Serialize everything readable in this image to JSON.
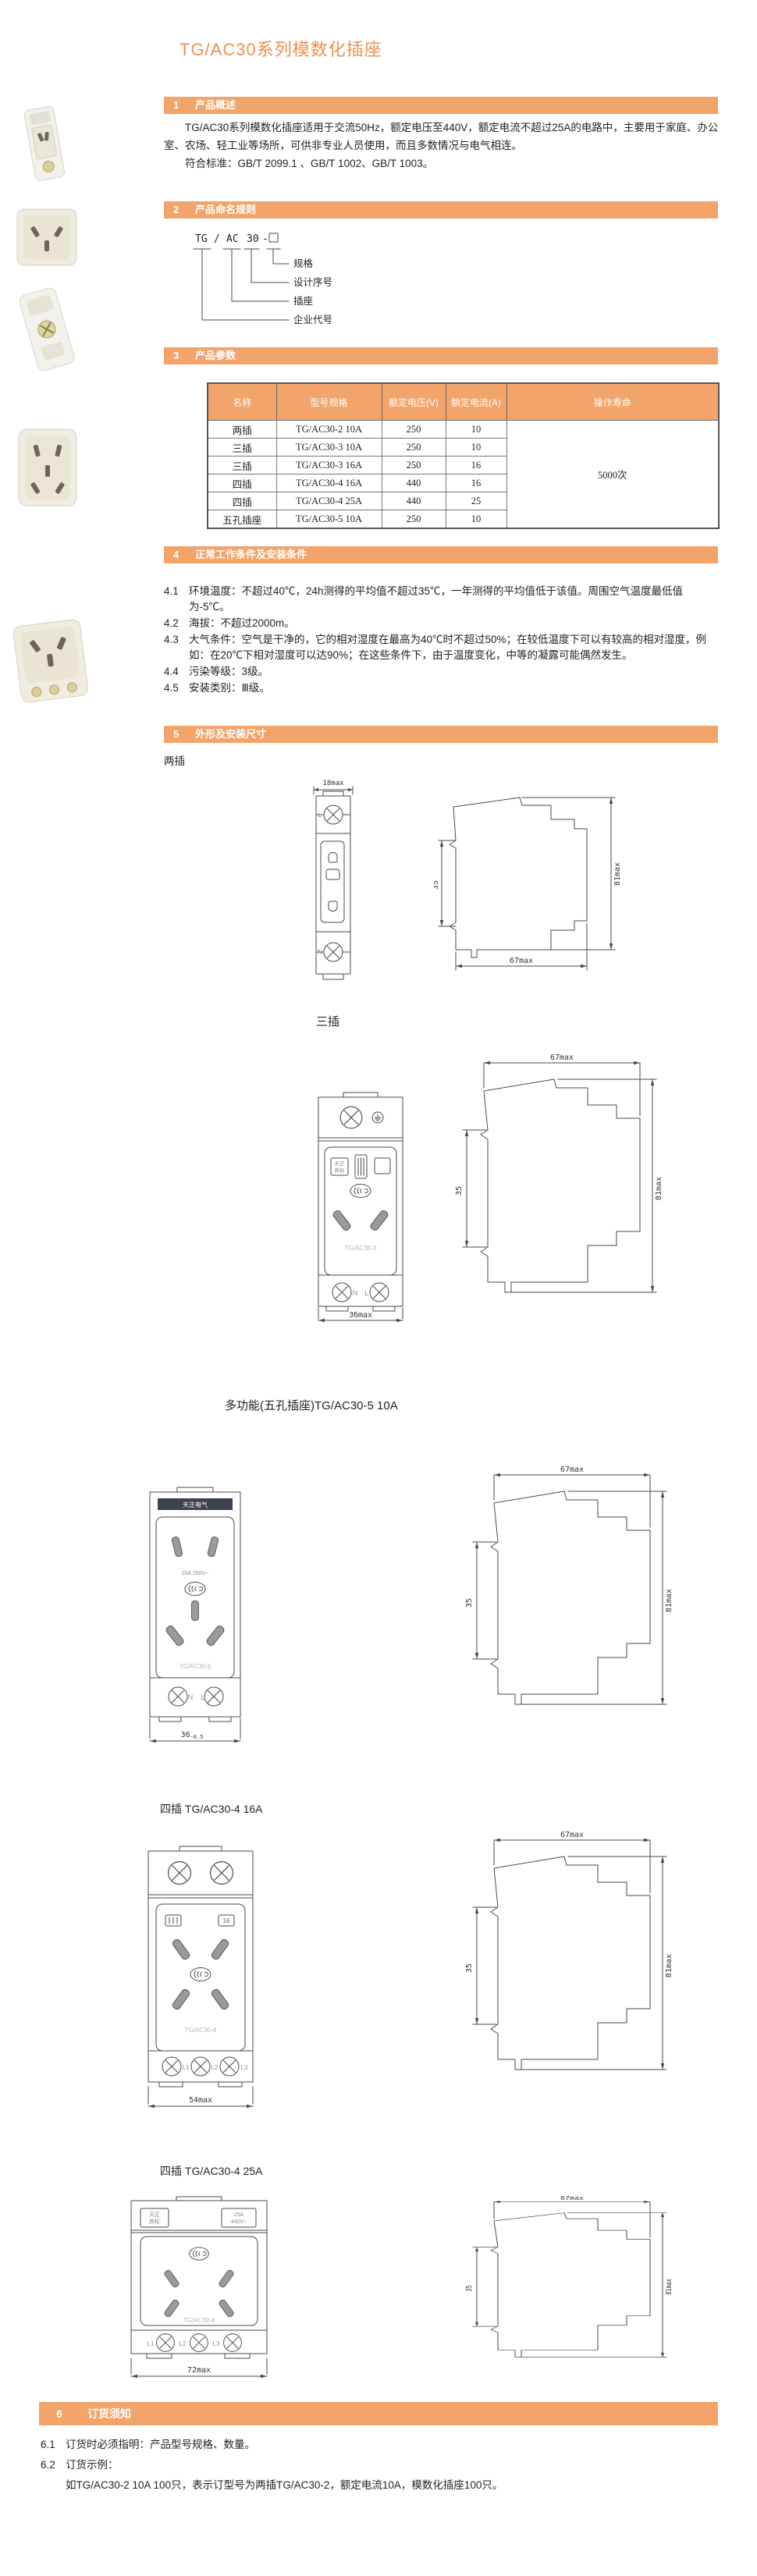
{
  "title": "TG/AC30系列模数化插座",
  "sections": {
    "s1": {
      "num": "1",
      "title": "产品概述"
    },
    "s2": {
      "num": "2",
      "title": "产品命名规则"
    },
    "s3": {
      "num": "3",
      "title": "产品参数"
    },
    "s4": {
      "num": "4",
      "title": "正常工作条件及安装条件"
    },
    "s5": {
      "num": "5",
      "title": "外形及安装尺寸"
    },
    "s6": {
      "num": "6",
      "title": "订货须知"
    }
  },
  "overview": {
    "p1": "TG/AC30系列模数化插座适用于交流50Hz，额定电压至440V，额定电流不超过25A的电路中，主要用于家庭、办公室、农场、轻工业等场所，可供非专业人员使用，而且多数情况与电气相连。",
    "p2": "符合标准：GB/T 2099.1 、GB/T 1002、GB/T 1003。"
  },
  "naming": {
    "seg1": "TG",
    "slash": "/",
    "seg2": "AC",
    "seg3": "30",
    "dash": "-",
    "labels": [
      "规格",
      "设计序号",
      "插座",
      "企业代号"
    ]
  },
  "table": {
    "headers": [
      "名称",
      "型号规格",
      "额定电压(V)",
      "额定电流(A)",
      "操作寿命"
    ],
    "rows": [
      [
        "两插",
        "TG/AC30-2 10A",
        "250",
        "10"
      ],
      [
        "三插",
        "TG/AC30-3 10A",
        "250",
        "10"
      ],
      [
        "三插",
        "TG/AC30-3 16A",
        "250",
        "16"
      ],
      [
        "四插",
        "TG/AC30-4 16A",
        "440",
        "16"
      ],
      [
        "四插",
        "TG/AC30-4 25A",
        "440",
        "25"
      ],
      [
        "五孔插座",
        "TG/AC30-5 10A",
        "250",
        "10"
      ]
    ],
    "lifespan": "5000次"
  },
  "conditions": [
    {
      "num": "4.1",
      "text": "环境温度：不超过40℃，24h测得的平均值不超过35℃，一年测得的平均值低于该值。周围空气温度最低值为-5℃。"
    },
    {
      "num": "4.2",
      "text": "海拔：不超过2000m。"
    },
    {
      "num": "4.3",
      "text": "大气条件：空气是干净的，它的相对湿度在最高为40℃时不超过50%；在较低温度下可以有较高的相对湿度，例如：在20℃下相对湿度可以达90%；在这些条件下，由于温度变化，中等的凝露可能偶然发生。"
    },
    {
      "num": "4.4",
      "text": "污染等级：3级。"
    },
    {
      "num": "4.5",
      "text": "安装类别：Ⅲ级。"
    }
  ],
  "side_dims": {
    "top": "67max",
    "left": "35",
    "right": "81max"
  },
  "d1": {
    "label": "两插",
    "top_dim": "18max",
    "term_top": "L",
    "term_bottom": "N"
  },
  "d2": {
    "label": "三插",
    "bottom_dim": "36max",
    "model": "TG/AC30-3",
    "brand1": "天正",
    "brand2": "商标",
    "term_left": "N",
    "term_right": "L"
  },
  "d3": {
    "label": "多功能(五孔插座)TG/AC30-5  10A",
    "dim_main": "36",
    "dim_tol": "-0.5",
    "brand": "天正电气",
    "rating": "10A 250V~",
    "model": "TG/AC30-5",
    "term_left": "N",
    "term_right": "L"
  },
  "d4": {
    "label": "四插 TG/AC30-4 16A",
    "bottom_dim": "54max",
    "box": "16",
    "model": "TG/AC30-4",
    "term1": "L1",
    "term2": "L2",
    "term3": "L3"
  },
  "d5": {
    "label": "四插 TG/AC30-4 25A",
    "bottom_dim": "72max",
    "brand1": "天正",
    "brand2": "商标",
    "rating1": "25A",
    "rating2": "440V~",
    "model": "TG/AC30-4",
    "term1": "L1",
    "term2": "L2",
    "term3": "L3"
  },
  "ordering": {
    "i1num": "6.1",
    "i1": "订货时必须指明：产品型号规格、数量。",
    "i2num": "6.2",
    "i2": "订货示例：",
    "example": "如TG/AC30-2 10A 100只，表示订型号为两插TG/AC30-2，额定电流10A，模数化插座100只。"
  },
  "colors": {
    "accent": "#F2A46B",
    "title_orange": "#ED9050"
  }
}
